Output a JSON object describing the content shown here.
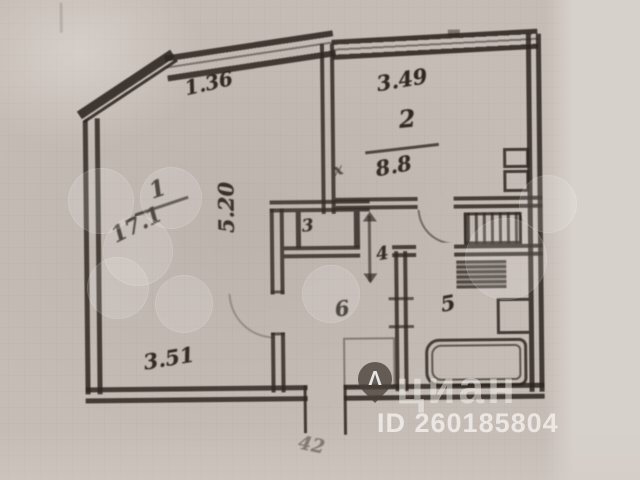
{
  "plan_type": "apartment-floor-plan-photo",
  "labels": {
    "dim_chamfer": "1.36",
    "dim_kitchen_width": "3.49",
    "dim_room1_depth": "5.20",
    "dim_room1_width": "3.51",
    "dim_entrance": "42",
    "room1_number": "1",
    "room1_area": "17.1",
    "room2_number": "2",
    "room2_area": "8.8",
    "room3_number": "3",
    "room4_number": "4",
    "room5_number": "5",
    "room6_number": "6",
    "door_cross_mark": "х"
  },
  "watermark": {
    "brand": "циан",
    "listing_id": "ID 260185804",
    "pin_glyph": "Λ"
  },
  "colors": {
    "paper": "#c6bcb6",
    "paper_light": "#d7d1cb",
    "ink": "#2c241e",
    "watermark_text": "#f8f5f2"
  }
}
